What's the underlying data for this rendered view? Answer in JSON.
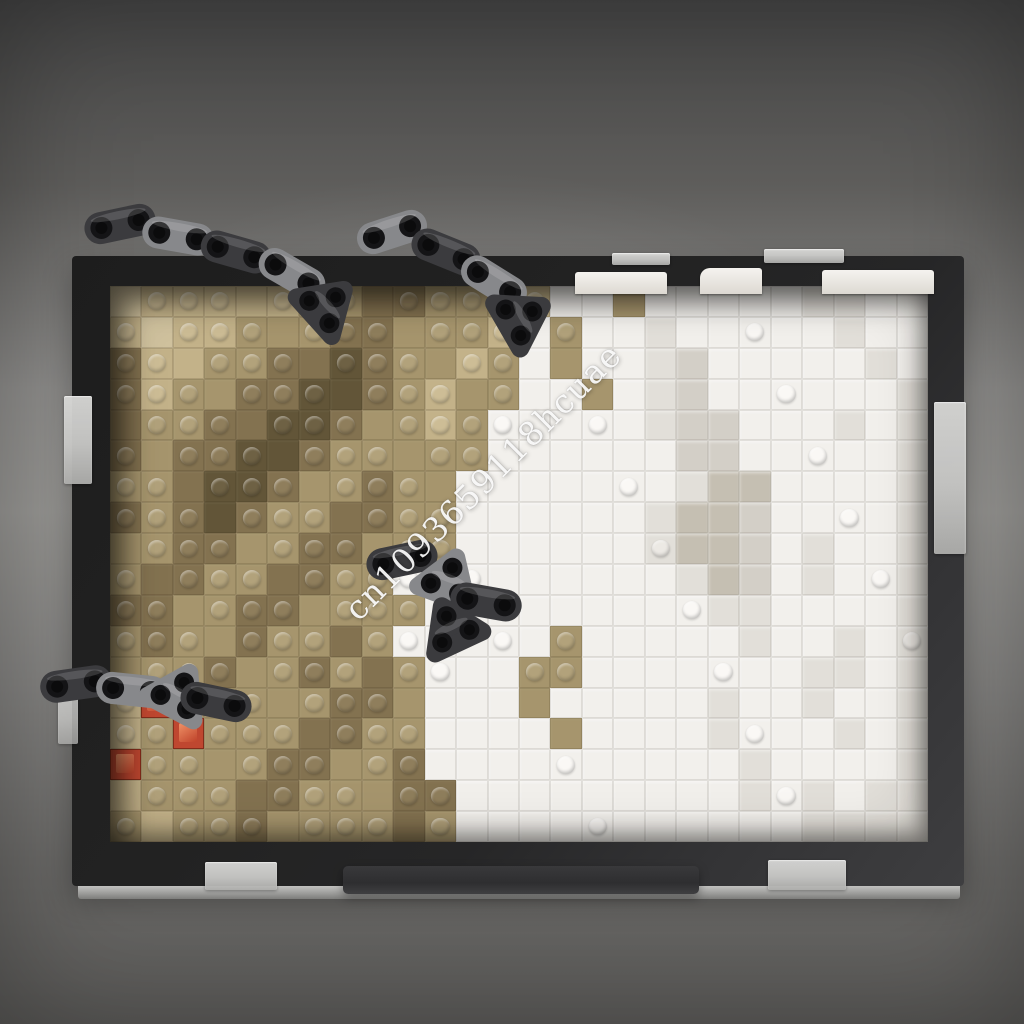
{
  "watermark": {
    "text": "cn1093659118hcuae"
  },
  "scene": {
    "description": "Brick-built two-tone relief mosaic (tan left half, white right half) in a dark frame with Technic liftarm chains draped over it, photographed on a gray studio backdrop"
  },
  "colors": {
    "backdrop_top": "#454545",
    "backdrop_mid": "#989794",
    "backdrop_bottom": "#5c5b59",
    "frame": "#232323",
    "frame_highlight": "#3e3e40",
    "liftarm_dark": "#3b3b3e",
    "liftarm_gray": "#87888b",
    "liftarm_hole": "#141416",
    "tan_light": "#c3b289",
    "tan_mid": "#a6956d",
    "tan_dark": "#837250",
    "tan_deep": "#625538",
    "tan_pale": "#d0c29e",
    "white_brick": "#f2f0ec",
    "white_shade": "#e2dfd9",
    "gray_white": "#d3cfc7",
    "warm_gray": "#c5bfb2",
    "trans_red": "#bf4730",
    "clear_tab": "#c9c9c7"
  },
  "mosaic": {
    "columns": 26,
    "rows": 18,
    "palette": {
      "a": {
        "fill": "#c3b289",
        "stud": "#cdbd96",
        "kind": "tan"
      },
      "b": {
        "fill": "#a6956d",
        "stud": "#b2a27b",
        "kind": "tan"
      },
      "c": {
        "fill": "#837250",
        "stud": "#8f7e5c",
        "kind": "tan"
      },
      "d": {
        "fill": "#625538",
        "stud": "#6e6144",
        "kind": "tan"
      },
      "e": {
        "fill": "#d0c29e",
        "stud": "#d9cca9",
        "kind": "tan"
      },
      "w": {
        "fill": "#f2f0ec",
        "stud": "#faf8f5",
        "kind": "white"
      },
      "x": {
        "fill": "#e2dfd9",
        "stud": "#ece9e4",
        "kind": "white"
      },
      "y": {
        "fill": "#d3cfc7",
        "stud": "#dedad3",
        "kind": "white"
      },
      "z": {
        "fill": "#c5bfb2",
        "stud": "#d0cabf",
        "kind": "white"
      },
      "W": {
        "fill": "#f2f0ec",
        "stud": "#faf8f5",
        "kind": "white-stud"
      },
      "r": {
        "fill": "#bf4730",
        "stud": "#d96a4a",
        "kind": "red"
      }
    },
    "grid": [
      "eaaaaabbccbbbawwbwwwwwxxww",
      "aeaabbbccbbbawbwwxwwwwwxww",
      "caabbccdcbbabwbwwxywwwwwxw",
      "cabbccddcbabbwwbwxywwwwwwx",
      "cbbccddcbbabWwwwwxyywwwxwx",
      "cbccddcbbbbbwwwwwwyywwwwwx",
      "bbcddcbbcbbwwwwwwwxzzwwwwx",
      "cbcdcbbccbbwwwwwwxzzywwwwx",
      "bbccbbccbbbwwwwwwxzzywxwwx",
      "bccbbccbbWbwwwwwwwxzywxwwx",
      "ccbbccbbbbwwwwwwwwwxxwwwwx",
      "bcbbcbbcbWwwwwbwwwwwxwwxwx",
      "bbbcbbcbcbWwwbbwwwwwwwxxwx",
      "arbbbbbccbwwwbwwwwwxwwxwwx",
      "abrbbbccbbwwwwbwwwwxwwwxwx",
      "rbbbbccbbcwwwwwwwwwwxwwwwx",
      "abbbccbbbccwwwwwwwwwxwxwxx",
      "babbcbbbbcbwwwwwwwwwwwxxxx"
    ]
  }
}
